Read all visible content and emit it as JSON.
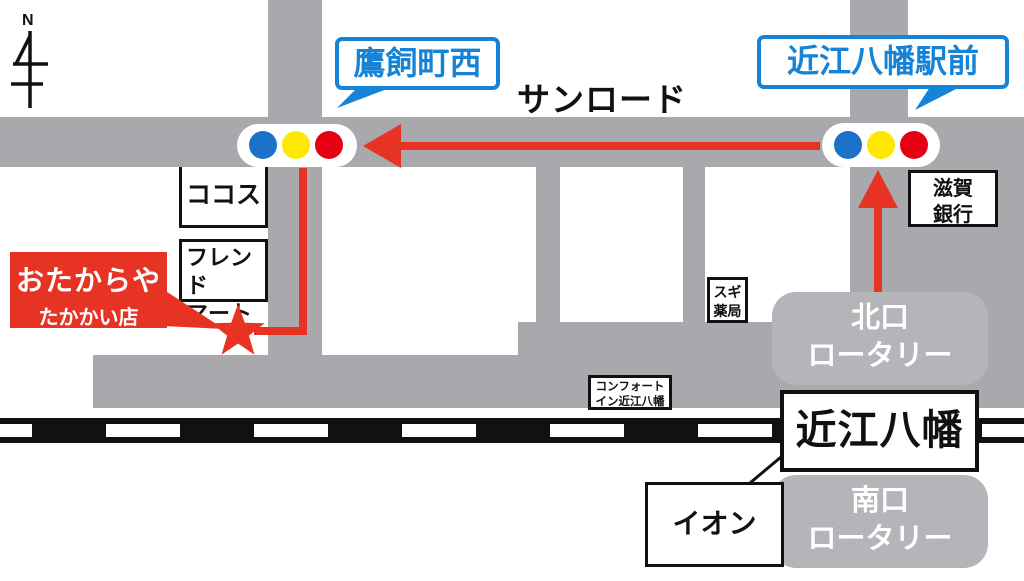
{
  "compass": {
    "label": "N"
  },
  "street_name": "サンロード",
  "signals": {
    "west_label": "鷹飼町西",
    "east_label": "近江八幡駅前",
    "lamp_icons": [
      "blue-light",
      "yellow-light",
      "red-light"
    ]
  },
  "store": {
    "name": "おたからや",
    "branch": "たかかい店"
  },
  "buildings": {
    "cocos": "ココス",
    "friend_mart": {
      "line1": "フレンド",
      "line2": "マート"
    },
    "sugi_pharmacy": {
      "line1": "スギ",
      "line2": "薬局"
    },
    "shiga_bank": {
      "line1": "滋賀",
      "line2": "銀行"
    },
    "comfort_inn": {
      "line1": "コンフォート",
      "line2": "イン近江八幡"
    },
    "aeon": "イオン"
  },
  "station": {
    "name": "近江八幡"
  },
  "rotary_north": {
    "line1": "北口",
    "line2": "ロータリー"
  },
  "rotary_south": {
    "line1": "南口",
    "line2": "ロータリー"
  },
  "colors": {
    "road_gray": "#a9a9ad",
    "rotary_gray": "#b5b5b9",
    "accent_red": "#e73323",
    "signal_blue": "#1c72c8",
    "signal_yellow": "#ffe800",
    "signal_red": "#e60012",
    "bubble_blue": "#1583d6",
    "railway_black": "#111111"
  }
}
